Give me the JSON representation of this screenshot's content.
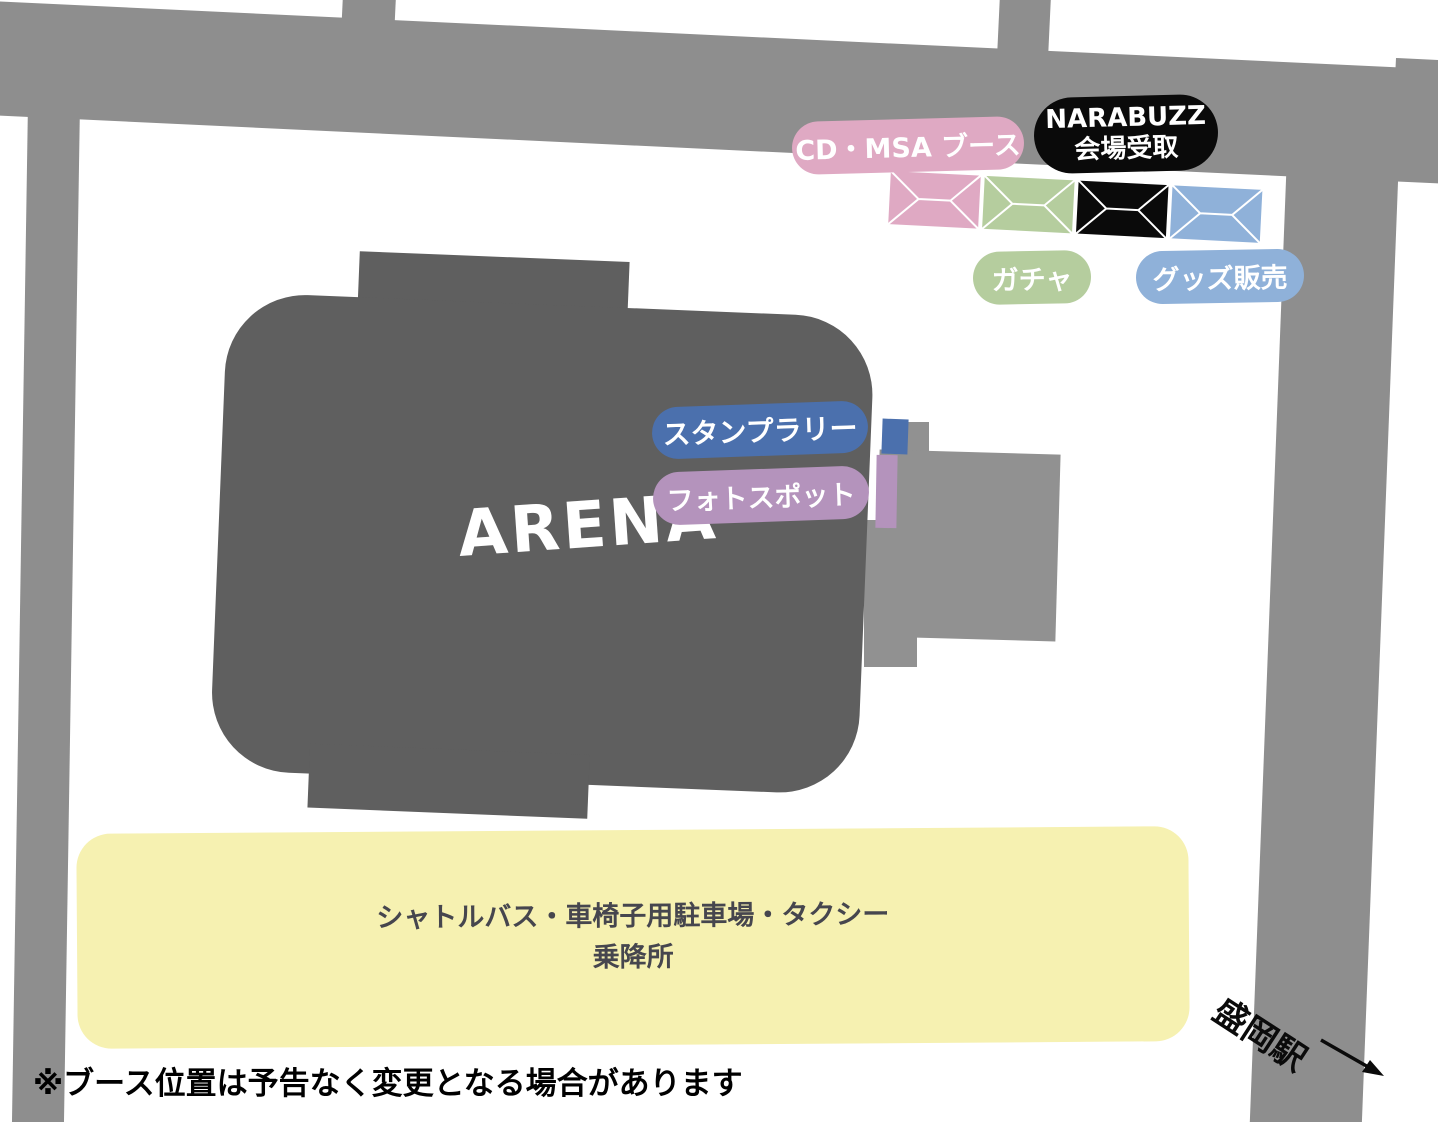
{
  "map": {
    "colors": {
      "road": "#8e8e8e",
      "plaza": "#919191",
      "arena": "#5f5f5f",
      "white": "#ffffff"
    },
    "arena": {
      "label": "ARENA",
      "color": "#5f5f5f",
      "text_color": "#ffffff"
    },
    "booths": [
      {
        "id": "cd-msa",
        "pill": "CD・MSA ブース",
        "pill_color": "#dfa9c3",
        "tent_color": "#dfa9c3",
        "text_color": "#ffffff"
      },
      {
        "id": "narabuzz",
        "pill_line1": "NARABUZZ",
        "pill_line2": "会場受取",
        "pill_color": "#0a0a0a",
        "tent_color": "#0a0a0a",
        "text_color": "#ffffff"
      },
      {
        "id": "gacha",
        "pill": "ガチャ",
        "pill_color": "#b5cd9e",
        "tent_color": "#b5cd9e",
        "text_color": "#ffffff"
      },
      {
        "id": "goods",
        "pill": "グッズ販売",
        "pill_color": "#8fb1d9",
        "tent_color": "#8fb1d9",
        "text_color": "#ffffff"
      }
    ],
    "markers": [
      {
        "id": "stamp-rally",
        "label": "スタンプラリー",
        "color": "#4b70ad",
        "text_color": "#ffffff"
      },
      {
        "id": "photo-spot",
        "label": "フォトスポット",
        "color": "#b493bc",
        "text_color": "#ffffff"
      }
    ],
    "shuttle": {
      "line1": "シャトルバス・車椅子用駐車場・タクシー",
      "line2": "乗降所",
      "bg": "#f6f1b1",
      "text_color": "#46464e"
    },
    "station": {
      "label": "盛岡駅"
    },
    "note": "※ブース位置は予告なく変更となる場合があります"
  }
}
